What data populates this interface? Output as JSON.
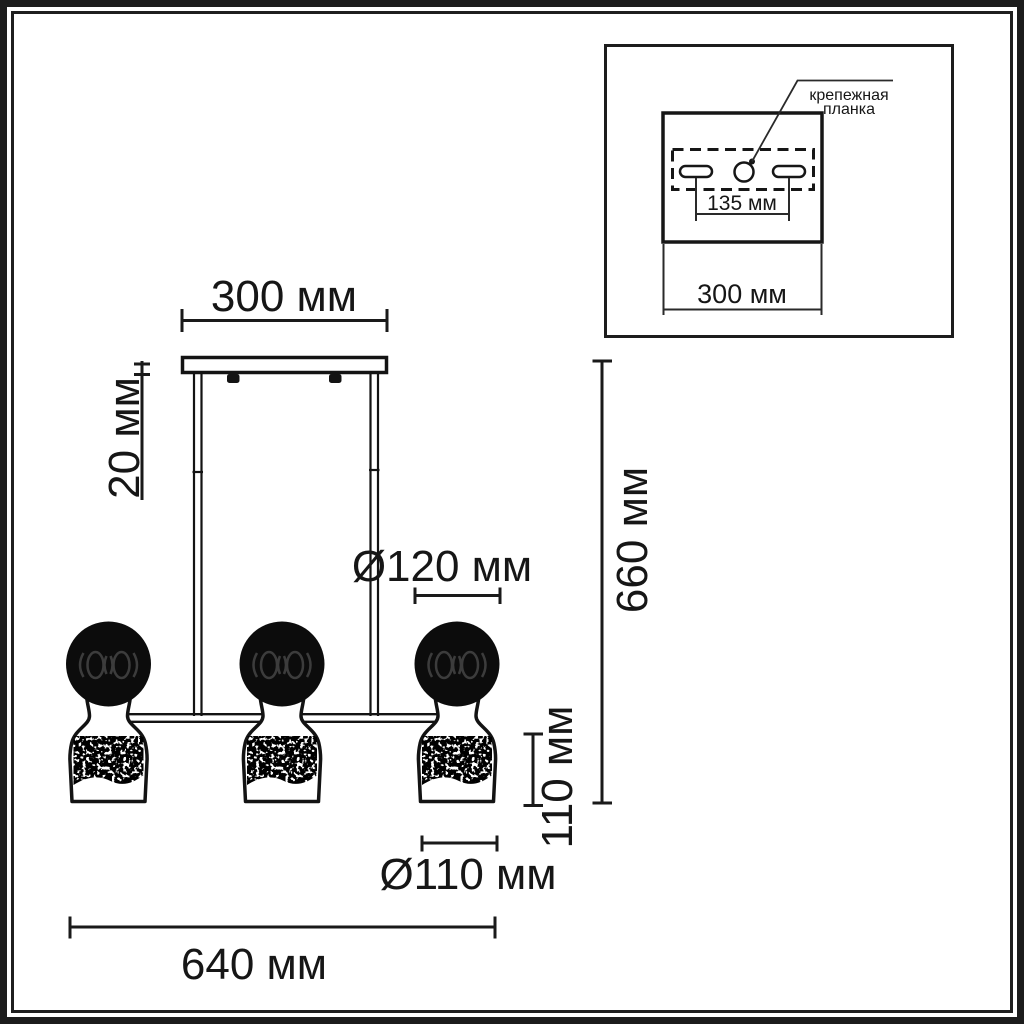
{
  "page": {
    "background": "#ffffff",
    "line_color": "#1a1a1a",
    "units": "мм"
  },
  "main_view": {
    "dim_canopy_width": "300 мм",
    "dim_canopy_height": "20 мм",
    "dim_sphere_diameter": "Ø120 мм",
    "dim_total_height": "660 мм",
    "dim_shade_height": "110 мм",
    "dim_shade_diameter": "Ø110 мм",
    "dim_total_width": "640 мм"
  },
  "inset_view": {
    "label_line1": "крепежная",
    "label_line2": "планка",
    "dim_hole_spacing": "135 мм",
    "dim_plate_width": "300 мм"
  }
}
